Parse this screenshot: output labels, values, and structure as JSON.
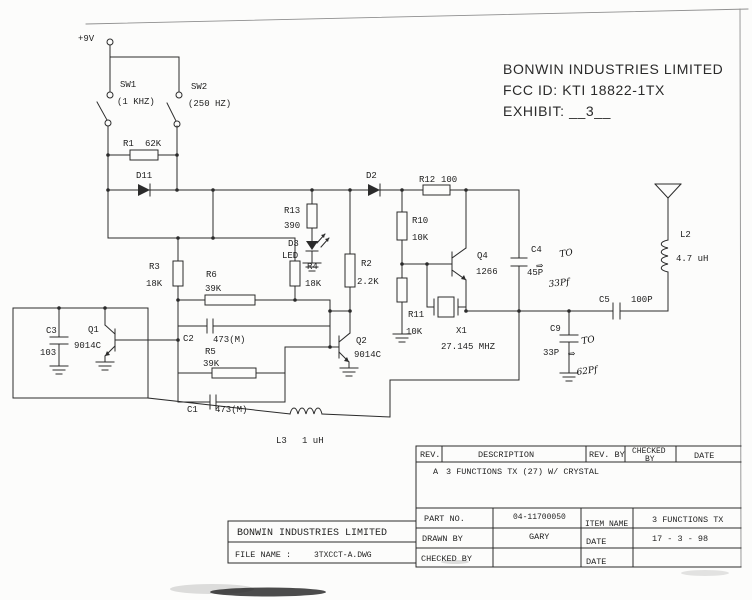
{
  "colors": {
    "paper": "#fcfcfb",
    "ink": "#2b2b2b",
    "handwriting": "#101010"
  },
  "header": {
    "line1": "BONWIN INDUSTRIES LIMITED",
    "line2": "FCC ID: KTI 18822-1TX",
    "line3": "EXHIBIT: __3__"
  },
  "sch": {
    "power": "+9V",
    "sw1_ref": "SW1",
    "sw1_val": "(1 KHZ)",
    "sw2_ref": "SW2",
    "sw2_val": "(250 HZ)",
    "r1_ref": "R1",
    "r1_val": "62K",
    "d11_ref": "D11",
    "d2_ref": "D2",
    "r12_ref": "R12",
    "r12_val": "100",
    "r13_ref": "R13",
    "r13_val": "390",
    "d3_ref": "D3",
    "d3_val": "LED",
    "r10_ref": "R10",
    "r10_val": "10K",
    "r3_ref": "R3",
    "r3_val": "18K",
    "r4_ref": "R4",
    "r4_val": "18K",
    "r6_ref": "R6",
    "r6_val": "39K",
    "r2_ref": "R2",
    "r2_val": "2.2K",
    "c3_ref": "C3",
    "c3_val": "103",
    "q1_ref": "Q1",
    "q1_val": "9014C",
    "c2_ref": "C2",
    "c2_val": "473(M)",
    "r5_ref": "R5",
    "r5_val": "39K",
    "c1_ref": "C1",
    "c1_val": "473(M)",
    "q2_ref": "Q2",
    "q2_val": "9014C",
    "r11_ref": "R11",
    "r11_val": "10K",
    "x1_ref": "X1",
    "x1_val": "27.145 MHZ",
    "q4_ref": "Q4",
    "q4_val": "1266",
    "c4_ref": "C4",
    "c4_val": "45P",
    "c9_ref": "C9",
    "c9_val": "33P",
    "c5_ref": "C5",
    "c5_val": "100P",
    "l2_ref": "L2",
    "l2_val": "4.7 uH",
    "l3_ref": "L3",
    "l3_val": "1 uH"
  },
  "handwritten": {
    "arrow": "⇒",
    "note1_to": "TO",
    "note1_val": "33Pf",
    "note2_to": "TO",
    "note2_val": "62Pf"
  },
  "title_block": {
    "rev_col": "REV.",
    "description_col": "DESCRIPTION",
    "rev_by_col": "REV. BY",
    "checked_by_col_1": "CHECKED",
    "checked_by_col_2": "BY",
    "date_col": "DATE",
    "rev": "A",
    "rev_description": "3 FUNCTIONS TX (27) W/ CRYSTAL",
    "part_no_label": "PART NO.",
    "part_no": "04-11700050",
    "item_name_label": "ITEM NAME",
    "item_name": "3 FUNCTIONS TX",
    "drawn_by_label": "DRAWN BY",
    "drawn_by": "GARY",
    "date1_label": "DATE",
    "date1": "17 - 3 - 98",
    "checked_by_label": "CHECKED BY",
    "date2_label": "DATE",
    "company": "BONWIN INDUSTRIES LIMITED",
    "file_name_label": "FILE NAME :",
    "file_name": "3TXCCT-A.DWG"
  }
}
